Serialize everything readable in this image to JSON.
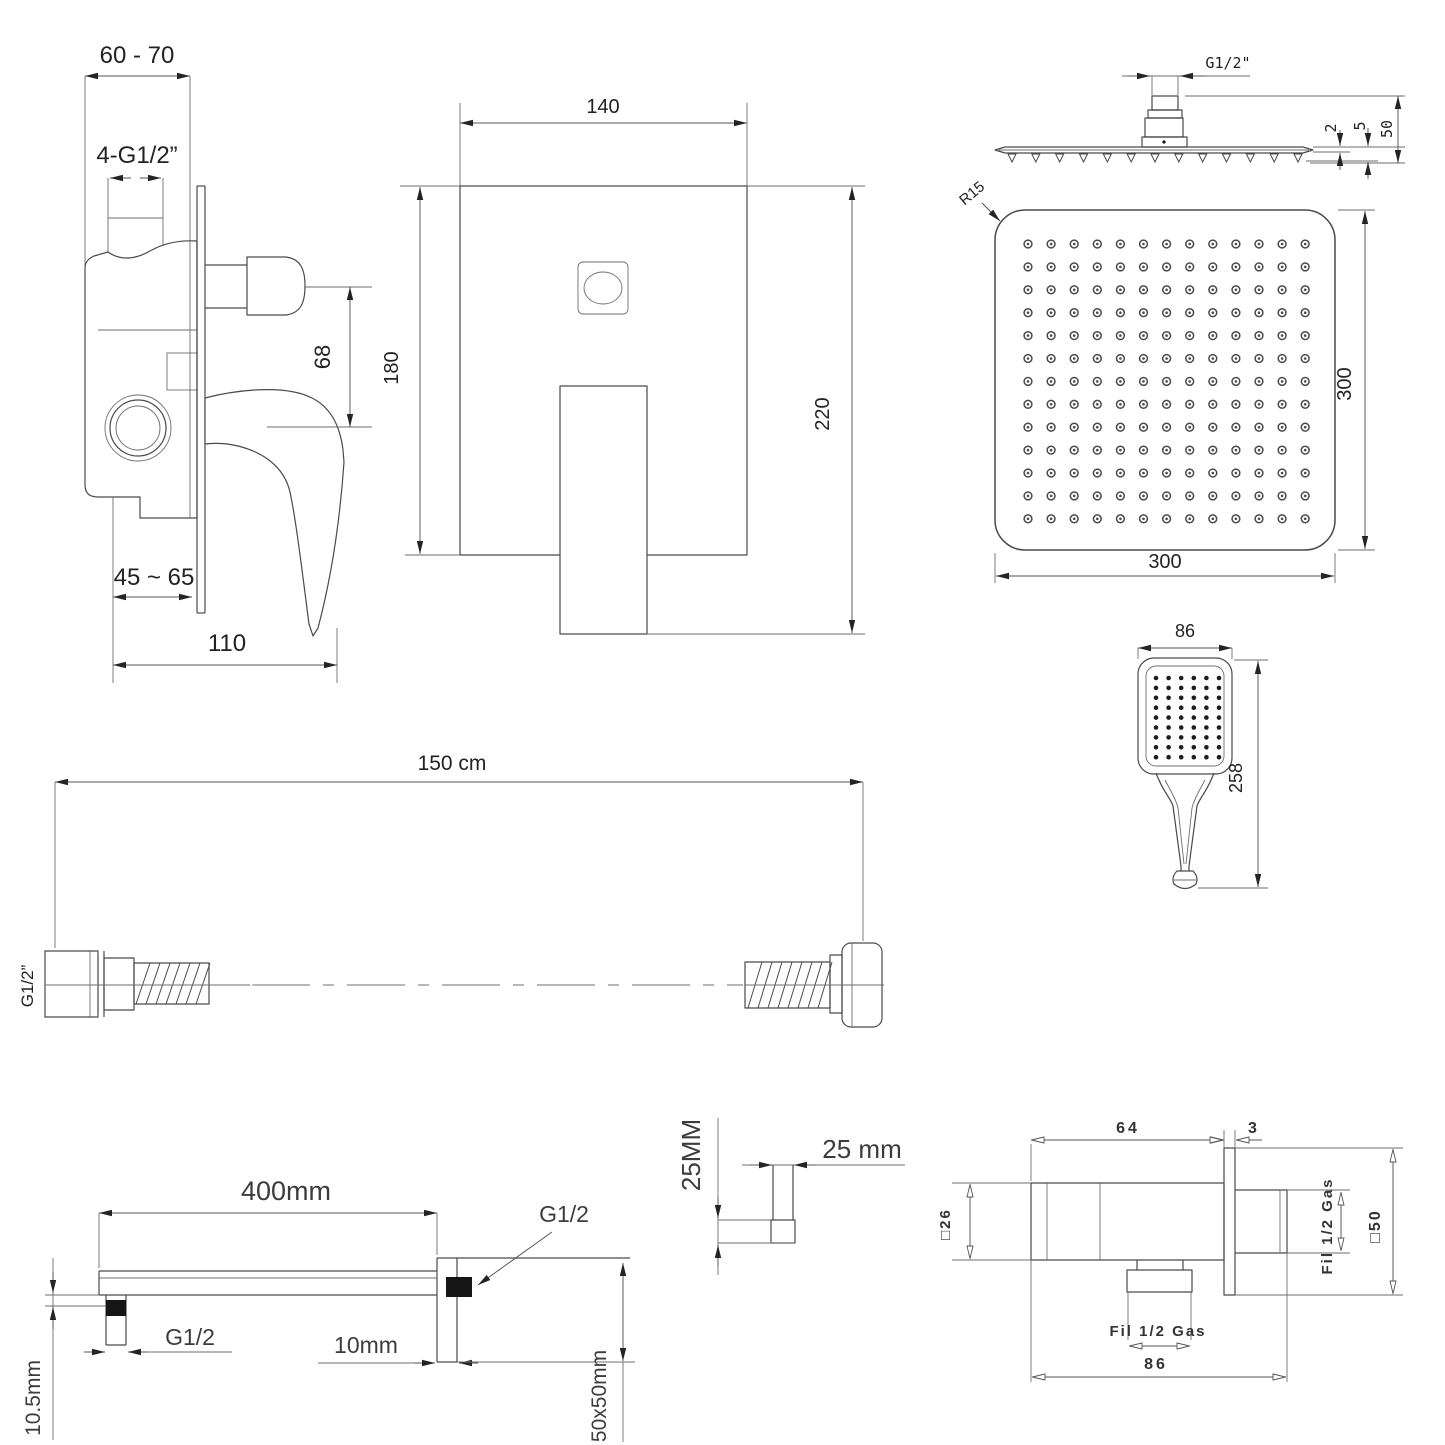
{
  "sheet_title": "Concealed shower system technical drawings",
  "drawings": {
    "mixer_side": {
      "labels": {
        "wall_depth": "60 - 70",
        "thread": "4-G1/2”",
        "knob_offset": "68",
        "depth_range": "45 ~ 65",
        "width": "110"
      }
    },
    "mixer_front": {
      "labels": {
        "width": "140",
        "height": "180",
        "total_height": "220"
      }
    },
    "head_side": {
      "labels": {
        "thread": "G1/2\"",
        "plate_thickness": "2",
        "edge_height": "5",
        "total_height": "50"
      }
    },
    "head_face": {
      "labels": {
        "corner_radius": "R15",
        "side": "300",
        "bottom": "300"
      },
      "nozzle_grid": {
        "cols": 13,
        "rows": 13
      }
    },
    "hand_shower": {
      "labels": {
        "width": "86",
        "length": "258"
      },
      "nozzle_grid": {
        "cols": 6,
        "rows": 9
      }
    },
    "hose": {
      "labels": {
        "length": "150 cm",
        "thread": "G1/2”"
      }
    },
    "shower_arm": {
      "labels": {
        "length": "400mm",
        "thread_wall": "G1/2",
        "thread_left": "G1/2",
        "offset": "10mm",
        "drop": "10.5mm",
        "flange": "50x50mm"
      }
    },
    "bracket": {
      "labels": {
        "height": "25MM",
        "width": "25 mm"
      }
    },
    "wall_outlet": {
      "labels": {
        "body": "64",
        "plate": "3",
        "square26": "□26",
        "thread_rear": "Fil 1/2 Gas",
        "square50": "□50",
        "thread_bottom": "Fil 1/2 Gas",
        "depth": "86"
      }
    }
  }
}
